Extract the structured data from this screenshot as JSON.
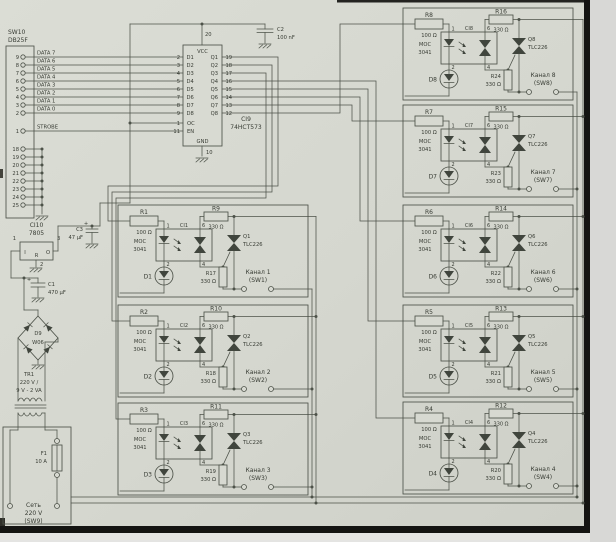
{
  "connector": {
    "name": "SW10",
    "type": "DB25F",
    "strobe_pin": "1",
    "strobe": "STROBE"
  },
  "dpins": [
    {
      "pin": "9",
      "data": "DATA 7",
      "din": "D1",
      "din_pin": "2",
      "q": "Q1",
      "q_pin": "19"
    },
    {
      "pin": "8",
      "data": "DATA 6",
      "din": "D2",
      "din_pin": "3",
      "q": "Q2",
      "q_pin": "18"
    },
    {
      "pin": "7",
      "data": "DATA 5",
      "din": "D3",
      "din_pin": "4",
      "q": "Q3",
      "q_pin": "17"
    },
    {
      "pin": "6",
      "data": "DATA 4",
      "din": "D4",
      "din_pin": "5",
      "q": "Q4",
      "q_pin": "16"
    },
    {
      "pin": "5",
      "data": "DATA 3",
      "din": "D5",
      "din_pin": "6",
      "q": "Q5",
      "q_pin": "15"
    },
    {
      "pin": "4",
      "data": "DATA 2",
      "din": "D6",
      "din_pin": "7",
      "q": "Q6",
      "q_pin": "14"
    },
    {
      "pin": "3",
      "data": "DATA 1",
      "din": "D7",
      "din_pin": "8",
      "q": "Q7",
      "q_pin": "13"
    },
    {
      "pin": "2",
      "data": "DATA 0",
      "din": "D8",
      "din_pin": "9",
      "q": "Q8",
      "q_pin": "12"
    }
  ],
  "gpins": [
    {
      "pin": "18"
    },
    {
      "pin": "19"
    },
    {
      "pin": "20"
    },
    {
      "pin": "21"
    },
    {
      "pin": "22"
    },
    {
      "pin": "23"
    },
    {
      "pin": "24"
    },
    {
      "pin": "25"
    }
  ],
  "latch": {
    "ref": "CI9",
    "part": "74HCT573",
    "vcc": "VCC",
    "gnd": "GND",
    "vcc_pin": "20",
    "gnd_pin": "10",
    "oc": "OC",
    "oc_pin": "1",
    "en": "EN",
    "en_pin": "11"
  },
  "c2": {
    "ref": "C2",
    "value": "100 nF"
  },
  "c3": {
    "ref": "C3",
    "value": "47 µF",
    "plus": "+"
  },
  "c1": {
    "ref": "C1",
    "value": "470 µF",
    "plus": "+"
  },
  "reg": {
    "ref": "CI10",
    "part": "7805",
    "in": "I",
    "out": "O",
    "com": "R",
    "pin_in": "1",
    "pin_out": "3",
    "pin_com": "2"
  },
  "bridge": {
    "ref": "D9",
    "part": "W06"
  },
  "transformer": {
    "ref": "TR1",
    "v1": "220 V /",
    "v2": "9 V - 2 VA"
  },
  "fuse": {
    "ref": "F1",
    "value": "10 A"
  },
  "mains": {
    "l1": "Сеть",
    "l2": "220 V",
    "l3": "(SW9)"
  },
  "shared": {
    "r_in_val": "100 Ω",
    "r_330": "330 Ω",
    "opto_line1": "MOC",
    "opto_line2": "3041",
    "triac_part": "TLC226",
    "pin1": "1",
    "pin2": "2",
    "pin4": "4",
    "pin6": "6"
  },
  "channels": [
    {
      "r_in": "R1",
      "ci": "CI1",
      "led": "D1",
      "r_top": "R9",
      "q": "Q1",
      "r_sn": "R17",
      "ch1": "Канал 1",
      "ch2": "(SW1)"
    },
    {
      "r_in": "R2",
      "ci": "CI2",
      "led": "D2",
      "r_top": "R10",
      "q": "Q2",
      "r_sn": "R18",
      "ch1": "Канал 2",
      "ch2": "(SW2)"
    },
    {
      "r_in": "R3",
      "ci": "CI3",
      "led": "D3",
      "r_top": "R11",
      "q": "Q3",
      "r_sn": "R19",
      "ch1": "Канал 3",
      "ch2": "(SW3)"
    },
    {
      "r_in": "R4",
      "ci": "CI4",
      "led": "D4",
      "r_top": "R12",
      "q": "Q4",
      "r_sn": "R20",
      "ch1": "Канал 4",
      "ch2": "(SW4)"
    },
    {
      "r_in": "R5",
      "ci": "CI5",
      "led": "D5",
      "r_top": "R13",
      "q": "Q5",
      "r_sn": "R21",
      "ch1": "Канал 5",
      "ch2": "(SW5)"
    },
    {
      "r_in": "R6",
      "ci": "CI6",
      "led": "D6",
      "r_top": "R14",
      "q": "Q6",
      "r_sn": "R22",
      "ch1": "Канал 6",
      "ch2": "(SW6)"
    },
    {
      "r_in": "R7",
      "ci": "CI7",
      "led": "D7",
      "r_top": "R15",
      "q": "Q7",
      "r_sn": "R23",
      "ch1": "Канал 7",
      "ch2": "(SW7)"
    },
    {
      "r_in": "R8",
      "ci": "CI8",
      "led": "D8",
      "r_top": "R16",
      "q": "Q8",
      "r_sn": "R24",
      "ch1": "Канал 8",
      "ch2": "(SW8)"
    }
  ],
  "colors": {
    "paper": "#d6d8d0",
    "ink": "#4d5249",
    "scan_border": "#141412"
  }
}
